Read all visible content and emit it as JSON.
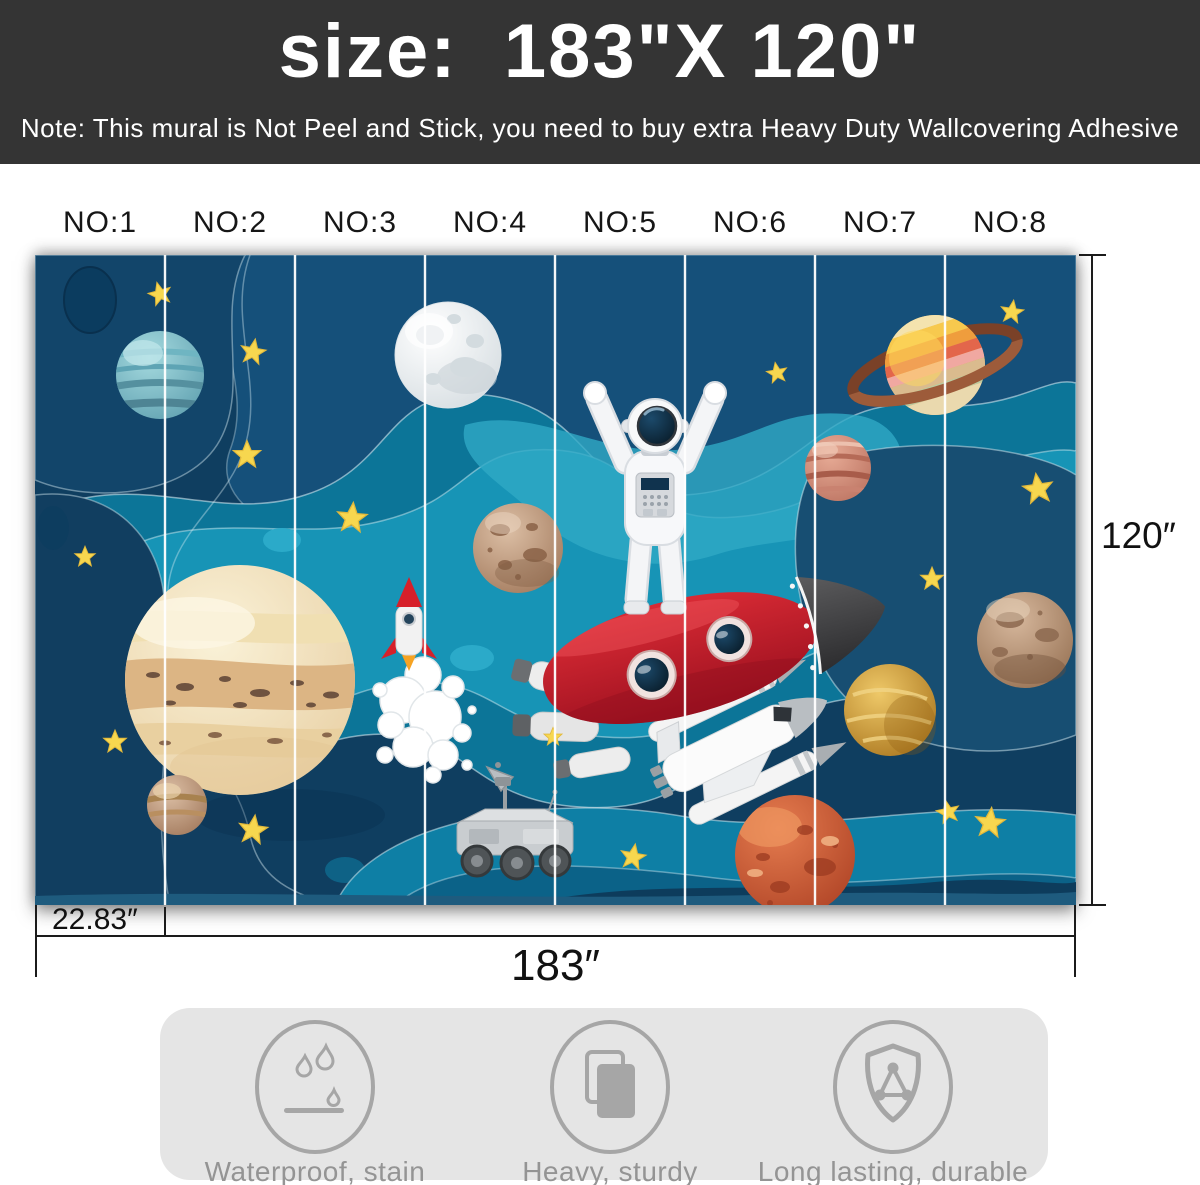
{
  "banner": {
    "title": "size:  183\"X 120\"",
    "note": "Note: This mural is Not Peel and Stick, you need to buy extra Heavy Duty Wallcovering Adhesive",
    "bg_color": "#343434"
  },
  "panels": {
    "labels": [
      "NO:1",
      "NO:2",
      "NO:3",
      "NO:4",
      "NO:5",
      "NO:6",
      "NO:7",
      "NO:8"
    ]
  },
  "dimensions": {
    "height": "120″",
    "panel_width": "22.83″",
    "total_width": "183″"
  },
  "mural": {
    "elements": [
      "moon-icon",
      "saturn-icon",
      "jupiter-icon",
      "uranus-icon",
      "pink-planet-icon",
      "red-planet-icon",
      "golden-planet-icon",
      "rocky-planet-icon",
      "astronaut-icon",
      "red-rocket-icon",
      "small-rocket-icon",
      "space-shuttle-icon",
      "mars-rover-icon",
      "star-icon"
    ],
    "colors": {
      "navy": "#0F3E60",
      "teal": "#0C7598",
      "bright_teal": "#1794B6",
      "star_yellow": "#F7D74F"
    }
  },
  "features": [
    {
      "icon": "waterproof-icon",
      "label": "Waterproof, stain resistant"
    },
    {
      "icon": "heavy-sturdy-icon",
      "label": "Heavy, sturdy"
    },
    {
      "icon": "durable-shield-icon",
      "label": "Long lasting, durable"
    }
  ],
  "features_panel": {
    "bg_color": "#E5E5E5",
    "icon_color": "#A3A3A3"
  }
}
